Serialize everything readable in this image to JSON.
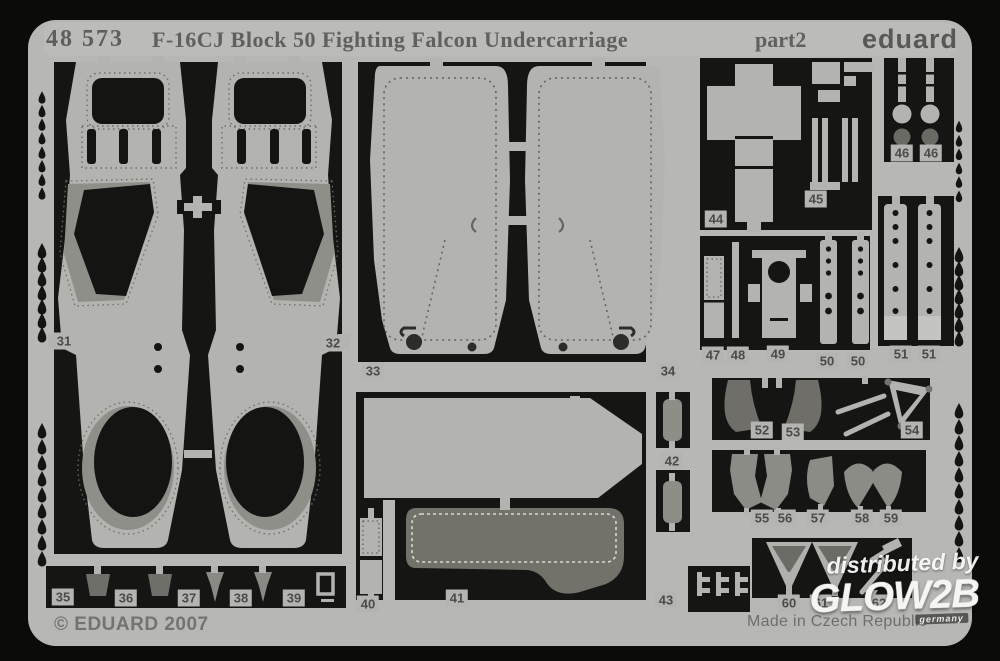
{
  "header": {
    "catalog_number": "48 573",
    "title": "F-16CJ Block 50 Fighting Falcon Undercarriage",
    "edition": "part2",
    "brand": "eduard"
  },
  "footer": {
    "copyright": "© EDUARD 2007",
    "origin": "Made in Czech Republic"
  },
  "watermark": {
    "prefix": "distributed by",
    "name": "GLOW2B",
    "country": "germany"
  },
  "colors": {
    "background_black": "#141412",
    "fret_metal": "#b7b7b3",
    "part_light": "#b3b3af",
    "part_mid": "#8d8d88",
    "part_dark": "#6f6e68",
    "print_gray": "#60605e"
  },
  "parts": [
    "31",
    "32",
    "33",
    "34",
    "35",
    "36",
    "37",
    "38",
    "39",
    "40",
    "41",
    "42",
    "43",
    "44",
    "45",
    "46",
    "46",
    "47",
    "48",
    "49",
    "50",
    "50",
    "51",
    "51",
    "52",
    "53",
    "54",
    "55",
    "56",
    "57",
    "58",
    "59",
    "60",
    "61",
    "62"
  ]
}
